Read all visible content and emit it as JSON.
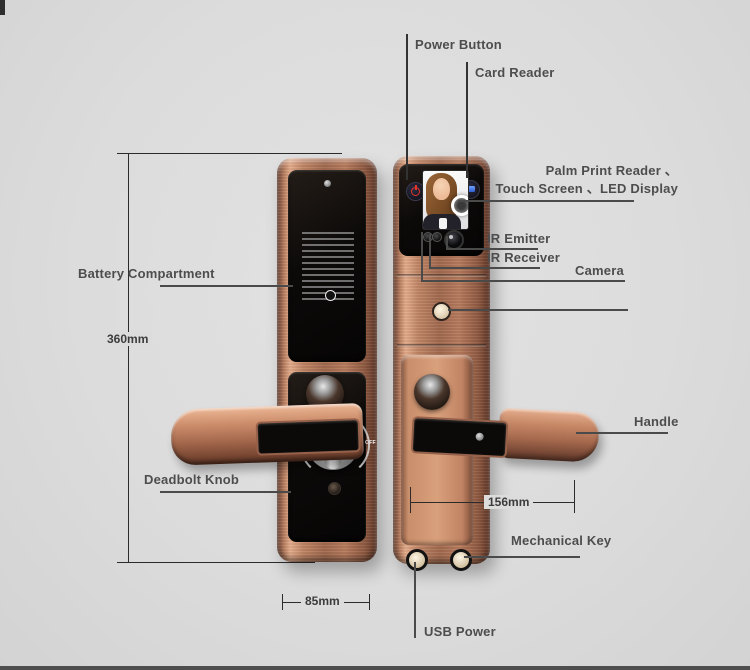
{
  "diagram_title": "smart door lock feature callout diagram",
  "labels": {
    "power_button": "Power Button",
    "card_reader": "Card Reader",
    "palm_line1": "Palm Print Reader 、",
    "palm_line2": "Touch Screen 、LED Display",
    "ir_emitter": "IR Emitter",
    "ir_receiver": "IR Receiver",
    "camera": "Camera",
    "battery_compartment": "Battery Compartment",
    "handle": "Handle",
    "deadbolt_knob": "Deadbolt Knob",
    "mechanical_key": "Mechanical Key",
    "usb_power": "USB Power"
  },
  "dimensions": {
    "height": "360mm",
    "width": "85mm",
    "depth": "156mm"
  },
  "deadbolt_markings": {
    "on": "ON",
    "off": "OFF"
  },
  "colors": {
    "background": "#dcdcdc",
    "copper_body": "#b0765a",
    "panel_black": "#0b0908",
    "label_text": "#4d4d4d",
    "leader_line": "#4a4a4a",
    "power_red": "#e23527",
    "card_blue": "#2d5fd0"
  }
}
